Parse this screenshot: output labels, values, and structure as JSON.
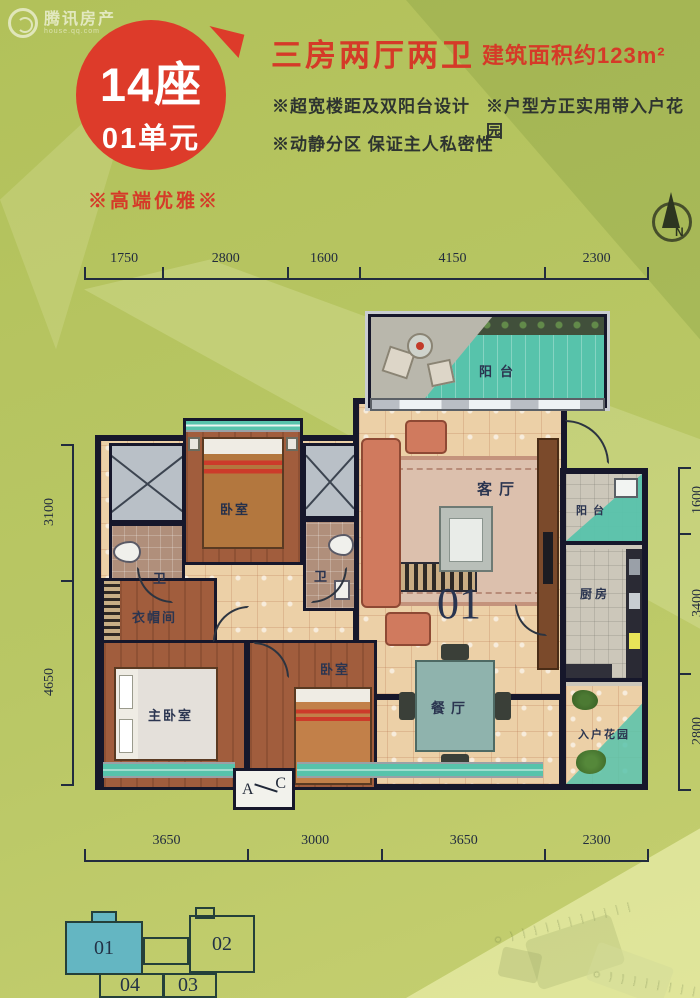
{
  "watermark": {
    "brand": "腾讯房产",
    "site": "house.qq.com"
  },
  "header": {
    "block_line1": "14座",
    "block_line2": "01单元",
    "layout_title": "三房两厅两卫",
    "area_text": "建筑面积约123m²",
    "features": [
      "※超宽楼距及双阳台设计",
      "※户型方正实用带入户花园",
      "※动静分区 保证主人私密性"
    ],
    "tagline": "※高端优雅※"
  },
  "compass": {
    "north_label": "N"
  },
  "dimensions": {
    "top": [
      "1750",
      "2800",
      "1600",
      "4150",
      "2300"
    ],
    "bottom": [
      "3650",
      "3000",
      "3650",
      "2300"
    ],
    "left": [
      "3100",
      "4650"
    ],
    "right": [
      "1600",
      "3400",
      "2800"
    ]
  },
  "plan": {
    "unit_number": "01",
    "rooms": {
      "balcony_top": "阳台",
      "bedroom_top": "卧室",
      "bath_left": "卫",
      "bath_right": "卫",
      "living": "客厅",
      "balcony_right": "阳台",
      "kitchen": "厨房",
      "cloakroom": "衣帽间",
      "master_bedroom": "主卧室",
      "bedroom_bottom": "卧室",
      "dining": "餐厅",
      "entry_garden": "入户花园"
    },
    "section_mark": {
      "start": "A",
      "end": "C"
    }
  },
  "keyplan": {
    "unit1": "01",
    "unit2": "02",
    "unit3": "03",
    "unit4": "04"
  },
  "colors": {
    "accent_red": "#d53a28",
    "teal": "#57c3ab",
    "wall": "#16172b",
    "background": "#b7c55f",
    "keyplan_highlight": "#64b6c2"
  }
}
